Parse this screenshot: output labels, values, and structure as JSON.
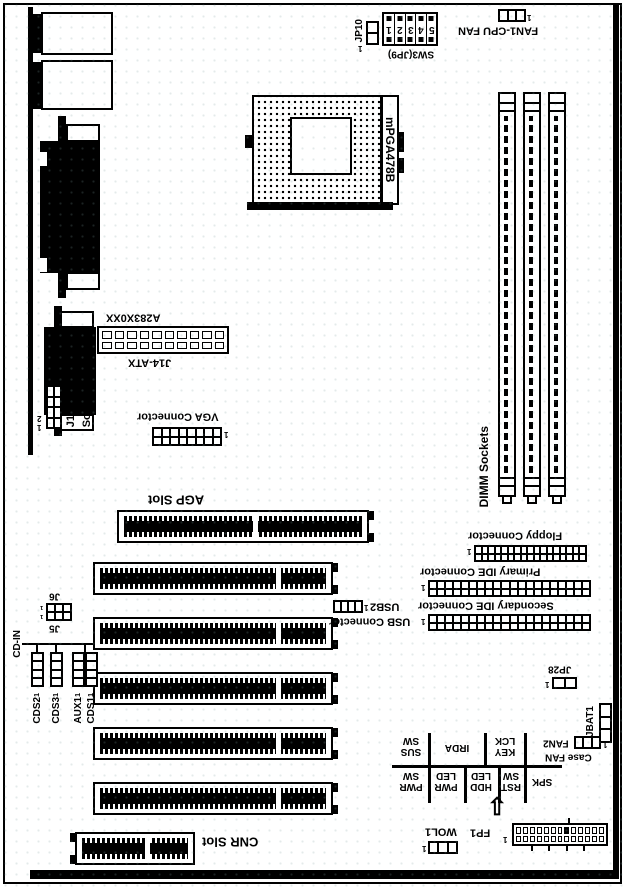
{
  "markers": {
    "one": "1",
    "two": "2",
    "arrow_up": "⇧"
  },
  "top_edge": {
    "jp10": "JP10",
    "sw3_label": "SW3(JP9)",
    "sw3_digits": [
      "1",
      "2",
      "3",
      "4",
      "5"
    ],
    "cpu_fan_label": "FAN1-CPU FAN"
  },
  "cpu": {
    "socket_label": "mPGA478B"
  },
  "memory": {
    "dimm_label": "DIMM Sockets"
  },
  "power": {
    "model_label": "A283X0XX",
    "atx_label": "J14-ATX"
  },
  "left_edge": {
    "sound_line1": "J10-Front Panel",
    "sound_line2": "Sound Connector",
    "cd_in": "CD-IN",
    "cds2": "CDS2",
    "cds3": "CDS3",
    "aux1": "AUX1",
    "cds1": "CDS1",
    "j6": "J6",
    "j5": "J5"
  },
  "video": {
    "vga_label": "VGA Connector",
    "agp_label": "AGP Slot"
  },
  "expansion": {
    "cnr_label": "CNR Slot"
  },
  "storage": {
    "floppy_label": "Floppy Connector",
    "primary_ide_label": "Primary IDE Connector",
    "secondary_ide_label": "Secondary IDE Connector"
  },
  "usb": {
    "usb2_label": "USB2",
    "usb_connector_label": "USB Connector"
  },
  "misc": {
    "jp28": "JP28",
    "jbat1": "JBAT1",
    "fan2": "FAN2",
    "case_fan": "Case FAN",
    "wol1": "WOL1",
    "fp1": "FP1"
  },
  "front_panel": {
    "top_row": [
      {
        "l1": "SUS",
        "l2": "SW"
      },
      {
        "l1": "IRDA",
        "l2": ""
      },
      {
        "l1": "KEY",
        "l2": "LCK"
      }
    ],
    "bottom_row": [
      {
        "l1": "PWR",
        "l2": "SW"
      },
      {
        "l1": "PWR",
        "l2": "LED"
      },
      {
        "l1": "HDD",
        "l2": "LED"
      },
      {
        "l1": "RST",
        "l2": "SW"
      },
      {
        "l1": "SPK",
        "l2": ""
      }
    ]
  }
}
